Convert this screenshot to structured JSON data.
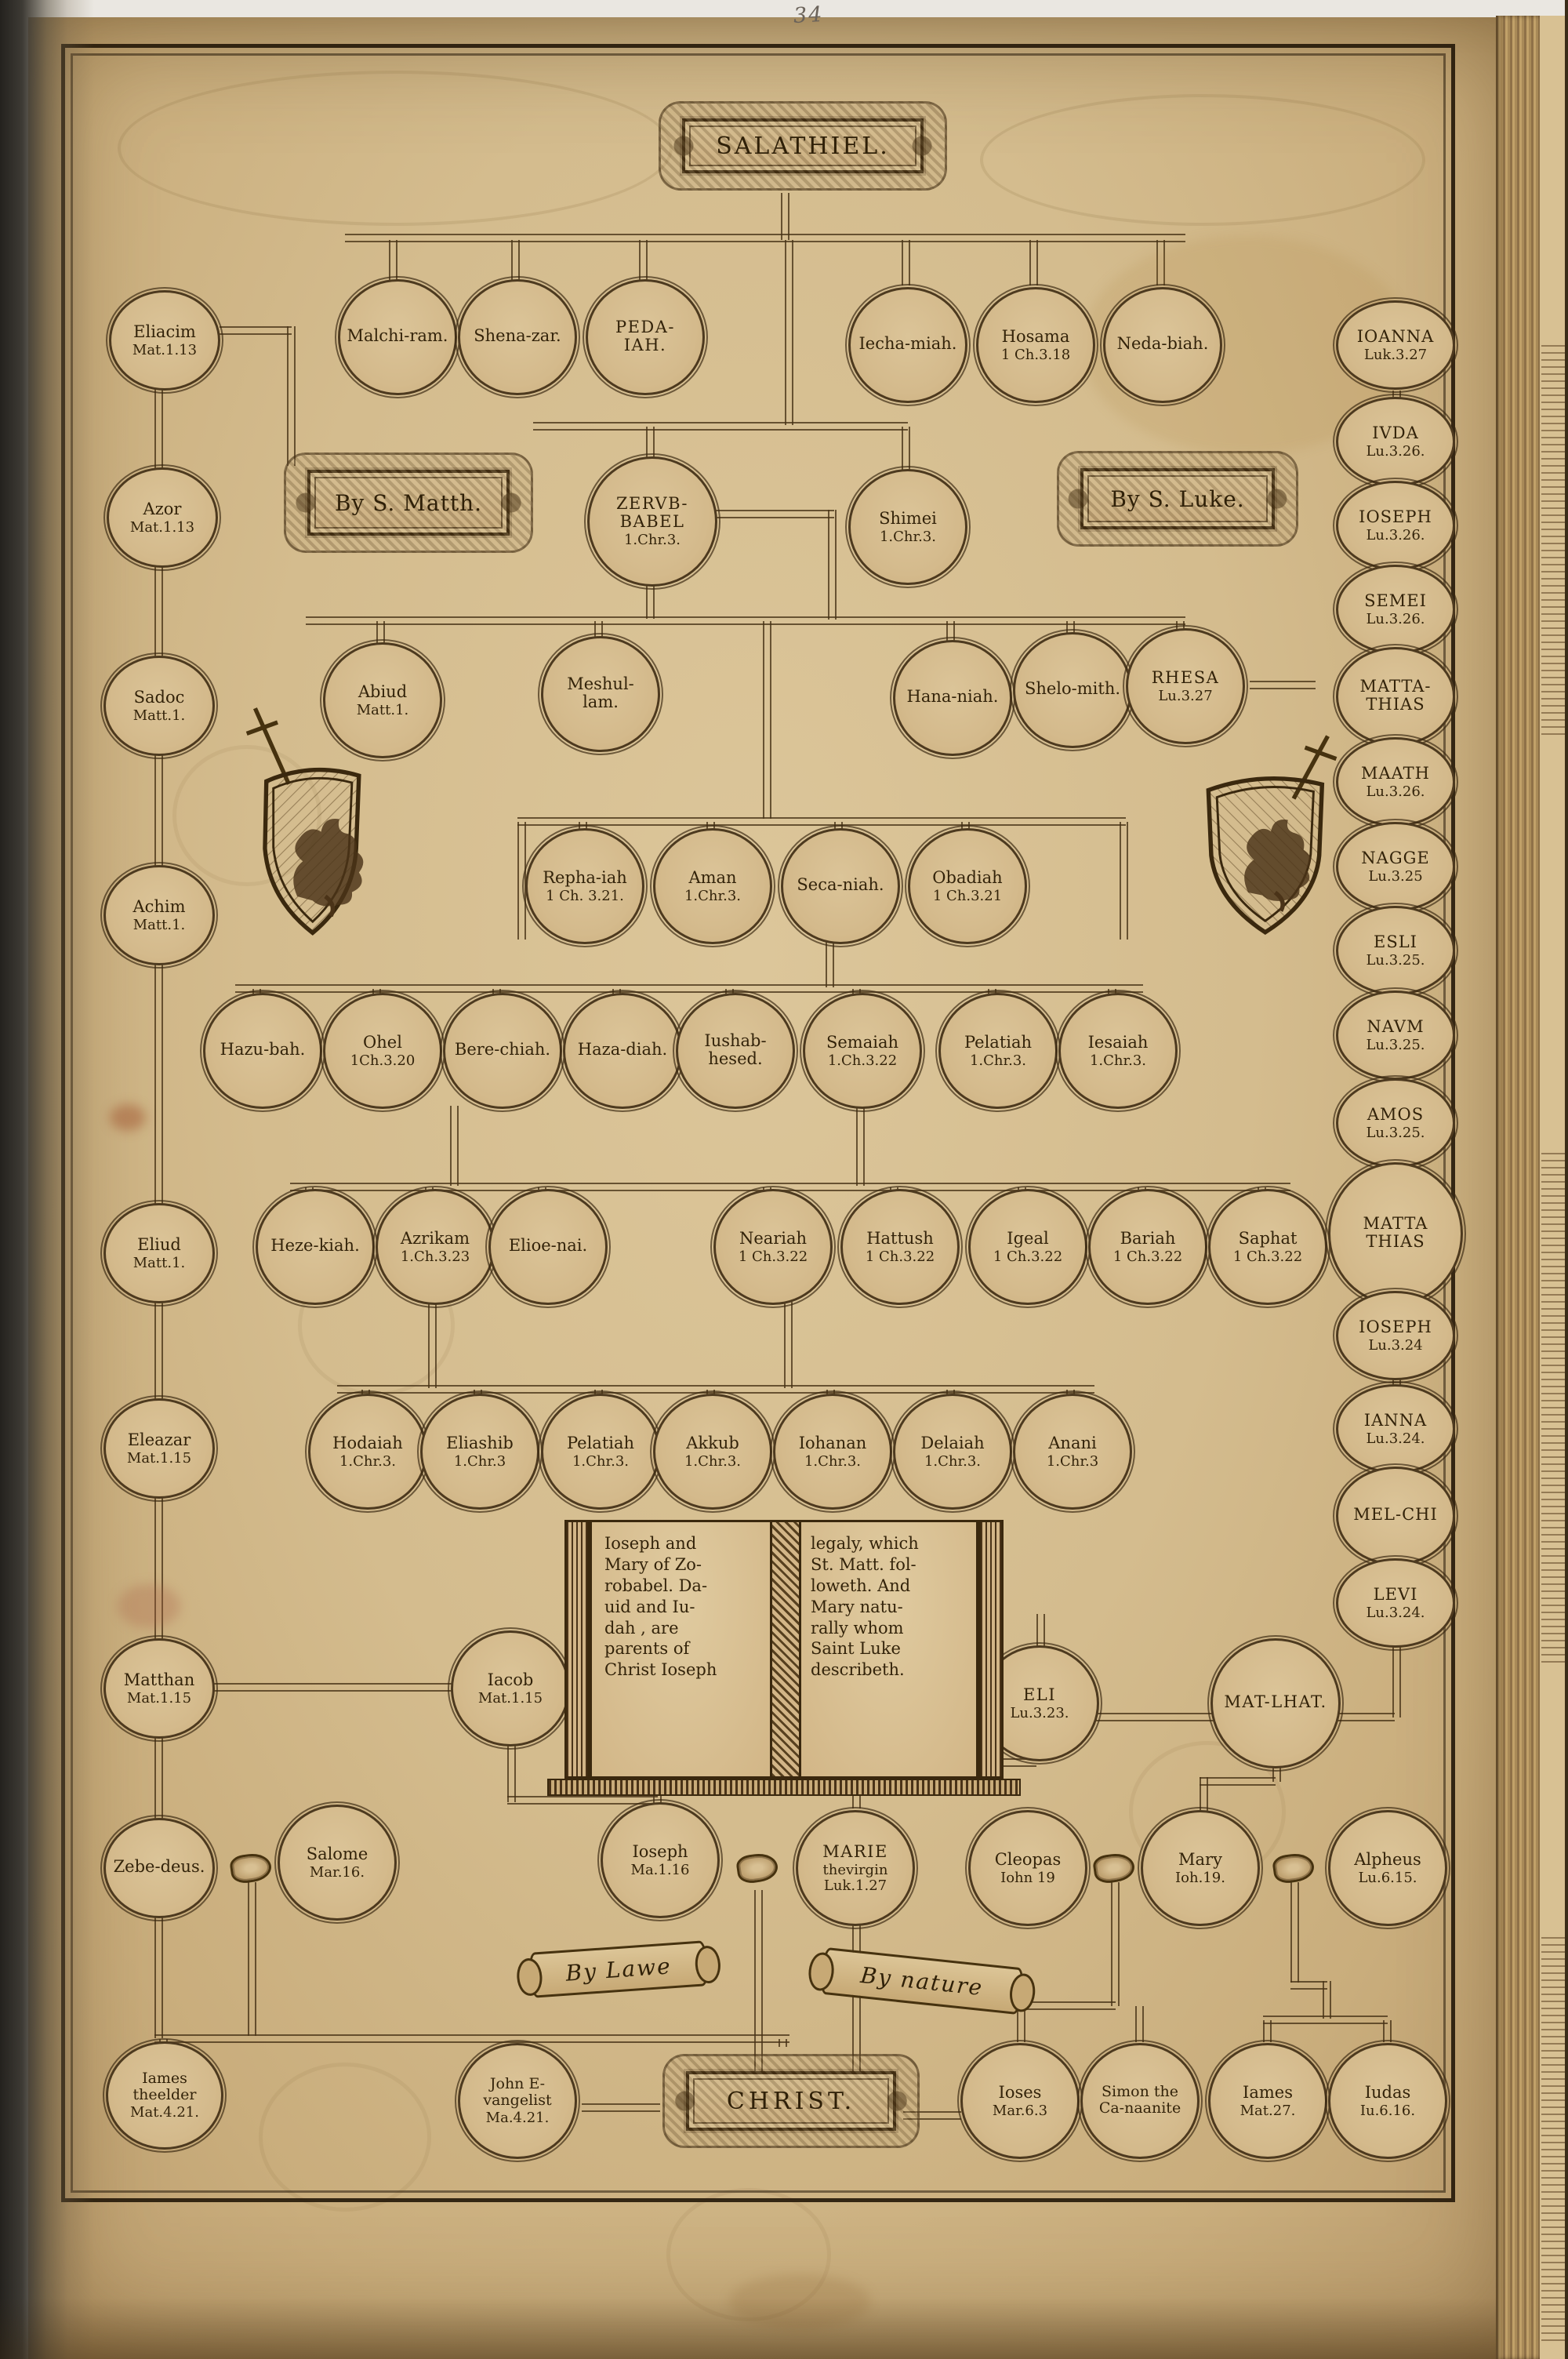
{
  "page_number": "34",
  "palette": {
    "paper": "#d4bc8e",
    "ink": "#3a280e",
    "line": "#46321a"
  },
  "cartouches": {
    "salathiel": "SALATHIEL.",
    "by_matthew": "By S. Matth.",
    "by_luke": "By S. Luke.",
    "by_law": "By Lawe",
    "by_nature": "By nature",
    "christ": "CHRIST."
  },
  "book_inscription": {
    "left": "Ioseph and\nMary of Zo-\nrobabel. Da-\nuid and Iu-\ndah , are\nparents of\nChrist Ioseph",
    "right": "legaly, which\nSt. Matt. fol-\nloweth. And\nMary natu-\nrally whom\nSaint Luke\ndescribeth."
  },
  "nodes": {
    "eliacim": {
      "name": "Eliacim",
      "ref": "Mat.1.13"
    },
    "azor": {
      "name": "Azor",
      "ref": "Mat.1.13"
    },
    "sadoc": {
      "name": "Sadoc",
      "ref": "Matt.1."
    },
    "achim": {
      "name": "Achim",
      "ref": "Matt.1."
    },
    "eliud": {
      "name": "Eliud",
      "ref": "Matt.1."
    },
    "eleazar": {
      "name": "Eleazar",
      "ref": "Mat.1.15"
    },
    "matthan": {
      "name": "Matthan",
      "ref": "Mat.1.15"
    },
    "zebedeus": {
      "name": "Zebe-deus.",
      "ref": ""
    },
    "iames_elder": {
      "name": "Iames theelder",
      "ref": "Mat.4.21."
    },
    "malchiram": {
      "name": "Malchi-ram.",
      "ref": ""
    },
    "shenazar": {
      "name": "Shena-zar.",
      "ref": ""
    },
    "pedaiah": {
      "name": "PEDA-IAH.",
      "ref": ""
    },
    "iechamiah": {
      "name": "Iecha-miah.",
      "ref": ""
    },
    "hosama": {
      "name": "Hosama",
      "ref": "1 Ch.3.18"
    },
    "nedabiah": {
      "name": "Neda-biah.",
      "ref": ""
    },
    "zerubbabel": {
      "name": "ZERVB-BABEL",
      "ref": "1.Chr.3."
    },
    "shimei": {
      "name": "Shimei",
      "ref": "1.Chr.3."
    },
    "abiud": {
      "name": "Abiud",
      "ref": "Matt.1."
    },
    "meshullam": {
      "name": "Meshul-lam.",
      "ref": ""
    },
    "hananiah": {
      "name": "Hana-niah.",
      "ref": ""
    },
    "shelomith": {
      "name": "Shelo-mith.",
      "ref": ""
    },
    "rhesa": {
      "name": "RHESA",
      "ref": "Lu.3.27"
    },
    "rephaiah": {
      "name": "Repha-iah",
      "ref": "1 Ch. 3.21."
    },
    "aman": {
      "name": "Aman",
      "ref": "1.Chr.3."
    },
    "secaniah": {
      "name": "Seca-niah.",
      "ref": ""
    },
    "obadiah": {
      "name": "Obadiah",
      "ref": "1 Ch.3.21"
    },
    "hazubah": {
      "name": "Hazu-bah.",
      "ref": ""
    },
    "ohel": {
      "name": "Ohel",
      "ref": "1Ch.3.20"
    },
    "berechiah": {
      "name": "Bere-chiah.",
      "ref": ""
    },
    "hazadiah": {
      "name": "Haza-diah.",
      "ref": ""
    },
    "iushabhesed": {
      "name": "Iushab-hesed.",
      "ref": ""
    },
    "semaiah": {
      "name": "Semaiah",
      "ref": "1.Ch.3.22"
    },
    "pelatiah_a": {
      "name": "Pelatiah",
      "ref": "1.Chr.3."
    },
    "iesaiah": {
      "name": "Iesaiah",
      "ref": "1.Chr.3."
    },
    "hezekiah": {
      "name": "Heze-kiah.",
      "ref": ""
    },
    "azrikam": {
      "name": "Azrikam",
      "ref": "1.Ch.3.23"
    },
    "elioenai": {
      "name": "Elioe-nai.",
      "ref": ""
    },
    "neariah": {
      "name": "Neariah",
      "ref": "1 Ch.3.22"
    },
    "hattush": {
      "name": "Hattush",
      "ref": "1 Ch.3.22"
    },
    "igeal": {
      "name": "Igeal",
      "ref": "1 Ch.3.22"
    },
    "bariah": {
      "name": "Bariah",
      "ref": "1 Ch.3.22"
    },
    "saphat": {
      "name": "Saphat",
      "ref": "1 Ch.3.22"
    },
    "hodaiah": {
      "name": "Hodaiah",
      "ref": "1.Chr.3."
    },
    "eliashib": {
      "name": "Eliashib",
      "ref": "1.Chr.3"
    },
    "pelatiah_b": {
      "name": "Pelatiah",
      "ref": "1.Chr.3."
    },
    "akkub": {
      "name": "Akkub",
      "ref": "1.Chr.3."
    },
    "iohanan": {
      "name": "Iohanan",
      "ref": "1.Chr.3."
    },
    "delaiah": {
      "name": "Delaiah",
      "ref": "1.Chr.3."
    },
    "anani": {
      "name": "Anani",
      "ref": "1.Chr.3"
    },
    "iacob": {
      "name": "Iacob",
      "ref": "Mat.1.15"
    },
    "eli": {
      "name": "ELI",
      "ref": "Lu.3.23."
    },
    "matlhat": {
      "name": "MAT-LHAT.",
      "ref": ""
    },
    "salome": {
      "name": "Salome",
      "ref": "Mar.16."
    },
    "ioseph_husband": {
      "name": "Ioseph",
      "ref": "Ma.1.16"
    },
    "marie": {
      "name": "MARIE",
      "ref": "thevirgin\nLuk.1.27"
    },
    "cleopas": {
      "name": "Cleopas",
      "ref": "Iohn 19"
    },
    "mary": {
      "name": "Mary",
      "ref": "Ioh.19."
    },
    "alpheus": {
      "name": "Alpheus",
      "ref": "Lu.6.15."
    },
    "john_evangelist": {
      "name": "John E-vangelist",
      "ref": "Ma.4.21."
    },
    "ioses": {
      "name": "Ioses",
      "ref": "Mar.6.3"
    },
    "simon": {
      "name": "Simon the Ca-naanite",
      "ref": ""
    },
    "iames_less": {
      "name": "Iames",
      "ref": "Mat.27."
    },
    "iudas": {
      "name": "Iudas",
      "ref": "Iu.6.16."
    },
    "ioanna": {
      "name": "IOANNA",
      "ref": "Luk.3.27"
    },
    "ivda": {
      "name": "IVDA",
      "ref": "Lu.3.26."
    },
    "ioseph_l1": {
      "name": "IOSEPH",
      "ref": "Lu.3.26."
    },
    "semei": {
      "name": "SEMEI",
      "ref": "Lu.3.26."
    },
    "mattathias1": {
      "name": "MATTA-THIAS",
      "ref": ""
    },
    "maath": {
      "name": "MAATH",
      "ref": "Lu.3.26."
    },
    "nagge": {
      "name": "NAGGE",
      "ref": "Lu.3.25"
    },
    "esli": {
      "name": "ESLI",
      "ref": "Lu.3.25."
    },
    "navm": {
      "name": "NAVM",
      "ref": "Lu.3.25."
    },
    "amos": {
      "name": "AMOS",
      "ref": "Lu.3.25."
    },
    "mattathias2": {
      "name": "MATTA THIAS",
      "ref": ""
    },
    "ioseph_l2": {
      "name": "IOSEPH",
      "ref": "Lu.3.24"
    },
    "ianna": {
      "name": "IANNA",
      "ref": "Lu.3.24."
    },
    "melchi": {
      "name": "MEL-CHI",
      "ref": ""
    },
    "levi": {
      "name": "LEVI",
      "ref": "Lu.3.24."
    }
  }
}
